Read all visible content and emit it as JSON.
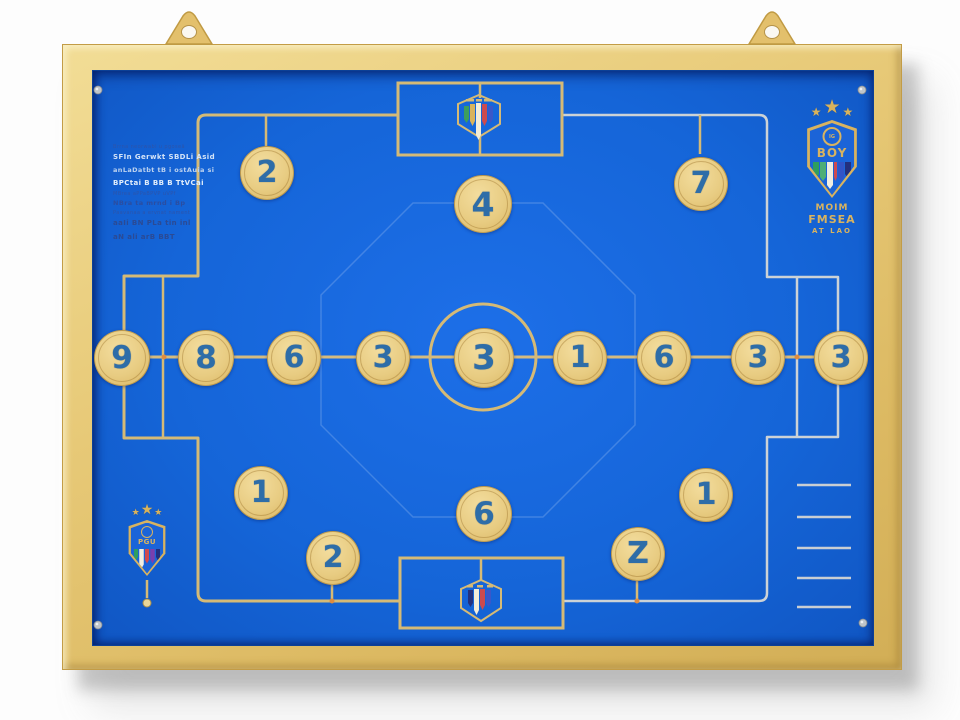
{
  "scene": {
    "description": "Wall-mounted football tactics board with numbered magnetic discs"
  },
  "icons": {
    "star": "★"
  },
  "discs": [
    {
      "label": "2"
    },
    {
      "label": "7"
    },
    {
      "label": "4"
    },
    {
      "label": "9"
    },
    {
      "label": "8"
    },
    {
      "label": "6"
    },
    {
      "label": "3"
    },
    {
      "label": "3"
    },
    {
      "label": "1"
    },
    {
      "label": "6"
    },
    {
      "label": "3"
    },
    {
      "label": "3"
    },
    {
      "label": "1"
    },
    {
      "label": "2"
    },
    {
      "label": "6"
    },
    {
      "label": "Z"
    },
    {
      "label": "1"
    }
  ],
  "left_text_block": {
    "lines": [
      "Brrna neorwabi u pgoseā",
      "SFIn Gerwkt SBDLi Asid",
      "anLaDatbt tB i ostAuia si",
      "BPCtai B BB B TtVCai",
      "MBrea aPPaBPVP uVPf",
      "NBra ta mrnd i Bp",
      "Paavanaa a ervnat nament",
      "aaIi BN PLa tin inl",
      "aN ali arB BBT"
    ]
  },
  "badge_top_right": {
    "circle_text": "IG",
    "crest_letters": "BOY",
    "text_lines": [
      "MOIM",
      "FMSEA",
      "AT LAO"
    ]
  },
  "badge_bottom_left": {
    "crest_letters": "PGU"
  },
  "colors": {
    "board_blue": "#1565d8",
    "line_gold": "#d5ba76",
    "line_silver": "#ccd2d6",
    "disc_gold": "#e8cc82",
    "number_blue": "#2e6da8",
    "frame_gold": "#e7c977"
  }
}
